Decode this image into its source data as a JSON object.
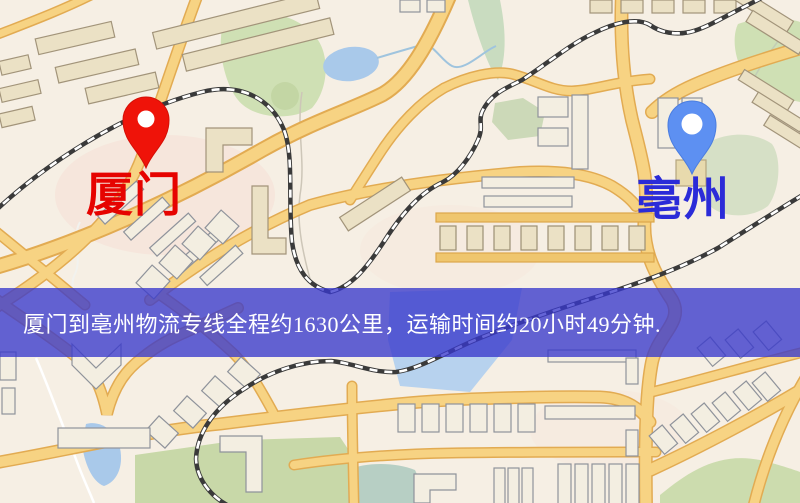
{
  "map": {
    "origin_marker": {
      "label": "厦门",
      "pin_color": "#ef1309",
      "label_color": "#e60300"
    },
    "destination_marker": {
      "label": "亳州",
      "pin_color": "#5d90f2",
      "label_color": "#2b2bd8"
    }
  },
  "info_banner": {
    "text": "厦门到亳州物流专线全程约1630公里，运输时间约20小时49分钟.",
    "origin": "厦门",
    "destination": "亳州",
    "distance_km": "1630",
    "duration_hours": "20",
    "duration_minutes": "49",
    "background_color": "#3838cc",
    "text_color": "#ffffff"
  },
  "map_palette": {
    "background": "#f6efe4",
    "road_fill": "#f7d383",
    "road_casing": "#e2ab52",
    "water": "#a9c9ea",
    "park": "#cfe0b4",
    "railway": "#3a3a3a",
    "building_fill": "#ebe1c5"
  }
}
